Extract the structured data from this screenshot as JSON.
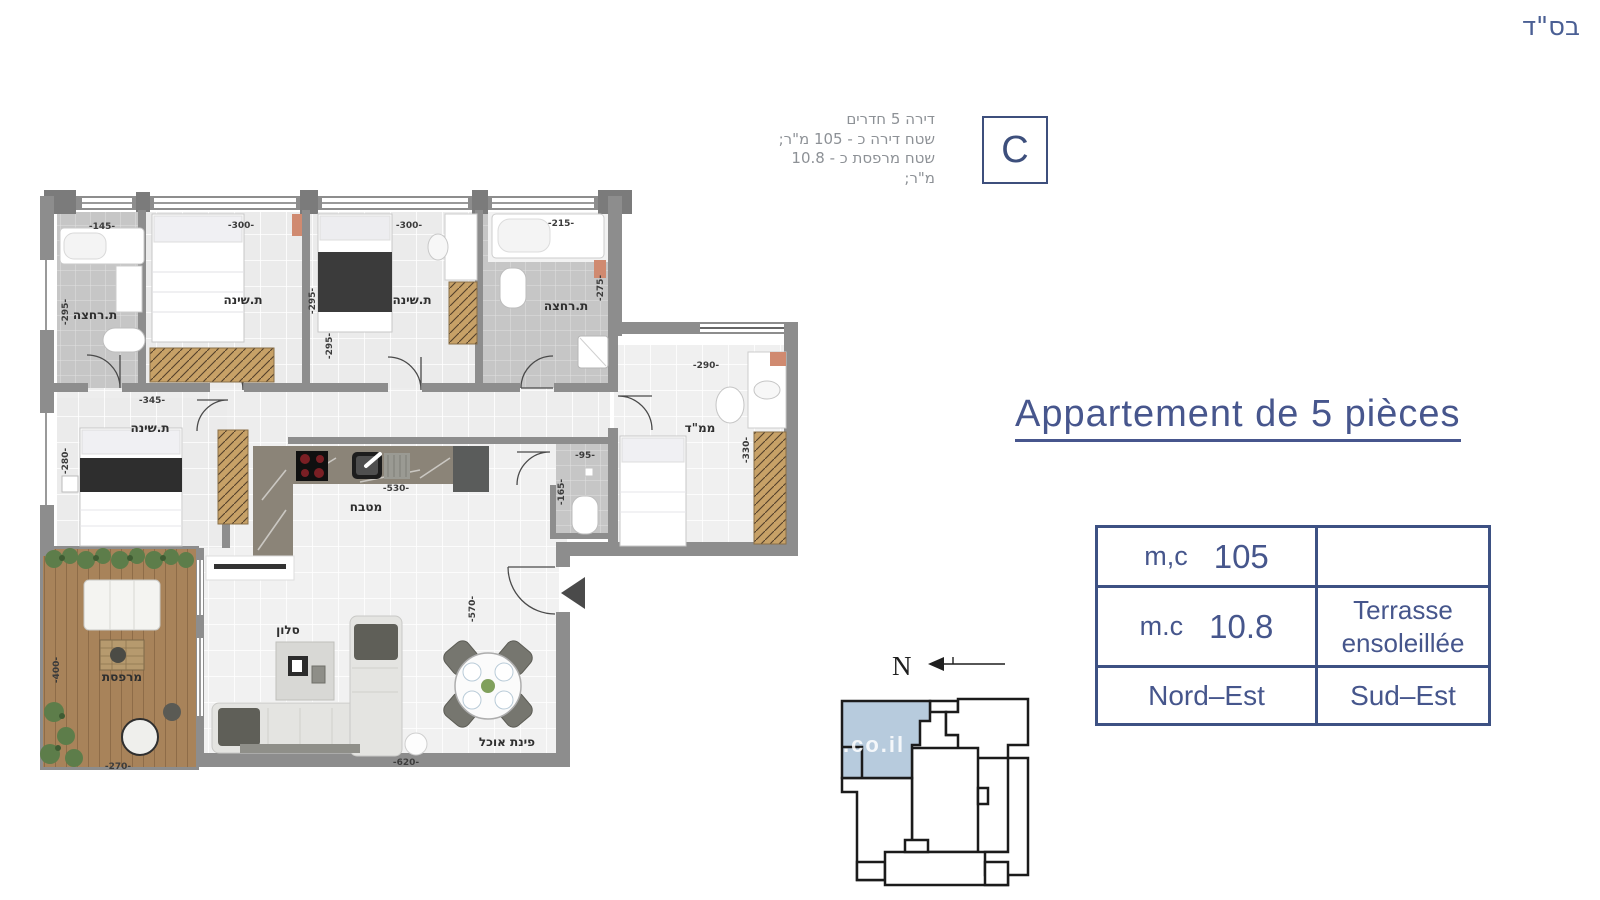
{
  "page": {
    "bsd": "בס\"ד"
  },
  "unit_info": {
    "letter": "C",
    "lines": [
      "דירה 5 חדרים",
      "שטח דירה כ - 105 מ\"ר;",
      "שטח מרפסת כ - 10.8 מ\"ר;"
    ]
  },
  "title": "Appartement de 5 pièces",
  "spec_table": {
    "area_label": "m,c",
    "area_value": "105",
    "terrace_label": "m.c",
    "terrace_value": "10.8",
    "terrace_desc_line1": "Terrasse",
    "terrace_desc_line2": "ensoleillée",
    "orientation_left": "Nord–Est",
    "orientation_right": "Sud–Est",
    "empty_cell": ""
  },
  "compass": {
    "north": "N"
  },
  "keyplan": {
    "watermark": ".co.il"
  },
  "plan": {
    "room_labels": [
      {
        "text": "ת.רחצה",
        "x": 95,
        "y": 315
      },
      {
        "text": "ת.שינה",
        "x": 243,
        "y": 300
      },
      {
        "text": "ת.שינה",
        "x": 412,
        "y": 300
      },
      {
        "text": "ת.רחצה",
        "x": 566,
        "y": 306
      },
      {
        "text": "ת.שינה",
        "x": 150,
        "y": 428
      },
      {
        "text": "מטבח",
        "x": 366,
        "y": 507
      },
      {
        "text": "ממ\"ד",
        "x": 700,
        "y": 428
      },
      {
        "text": "סלון",
        "x": 288,
        "y": 630
      },
      {
        "text": "מרפסת",
        "x": 122,
        "y": 677
      },
      {
        "text": "פינת אוכל",
        "x": 507,
        "y": 742
      }
    ],
    "dim_labels": [
      {
        "text": "-145-",
        "x": 102,
        "y": 227,
        "rot": 0
      },
      {
        "text": "-300-",
        "x": 241,
        "y": 226,
        "rot": 0
      },
      {
        "text": "-300-",
        "x": 409,
        "y": 226,
        "rot": 0
      },
      {
        "text": "-215-",
        "x": 561,
        "y": 224,
        "rot": 0
      },
      {
        "text": "-295-",
        "x": 66,
        "y": 312,
        "rot": 90
      },
      {
        "text": "-295-",
        "x": 313,
        "y": 301,
        "rot": 90
      },
      {
        "text": "-295-",
        "x": 330,
        "y": 346,
        "rot": 90
      },
      {
        "text": "-275-",
        "x": 601,
        "y": 288,
        "rot": 90
      },
      {
        "text": "-345-",
        "x": 152,
        "y": 401,
        "rot": 0
      },
      {
        "text": "-280-",
        "x": 66,
        "y": 461,
        "rot": 90
      },
      {
        "text": "-290-",
        "x": 706,
        "y": 366,
        "rot": 0
      },
      {
        "text": "-330-",
        "x": 747,
        "y": 450,
        "rot": 90
      },
      {
        "text": "-95-",
        "x": 585,
        "y": 456,
        "rot": 0
      },
      {
        "text": "-165-",
        "x": 562,
        "y": 492,
        "rot": 90
      },
      {
        "text": "-530-",
        "x": 396,
        "y": 489,
        "rot": 0
      },
      {
        "text": "-570-",
        "x": 473,
        "y": 609,
        "rot": 90
      },
      {
        "text": "-400-",
        "x": 57,
        "y": 670,
        "rot": 90
      },
      {
        "text": "-270-",
        "x": 118,
        "y": 767,
        "rot": 0
      },
      {
        "text": "-620-",
        "x": 406,
        "y": 763,
        "rot": 0
      }
    ]
  },
  "colors": {
    "accent": "#46568c",
    "keyplan_highlight": "#b7cbdd"
  }
}
